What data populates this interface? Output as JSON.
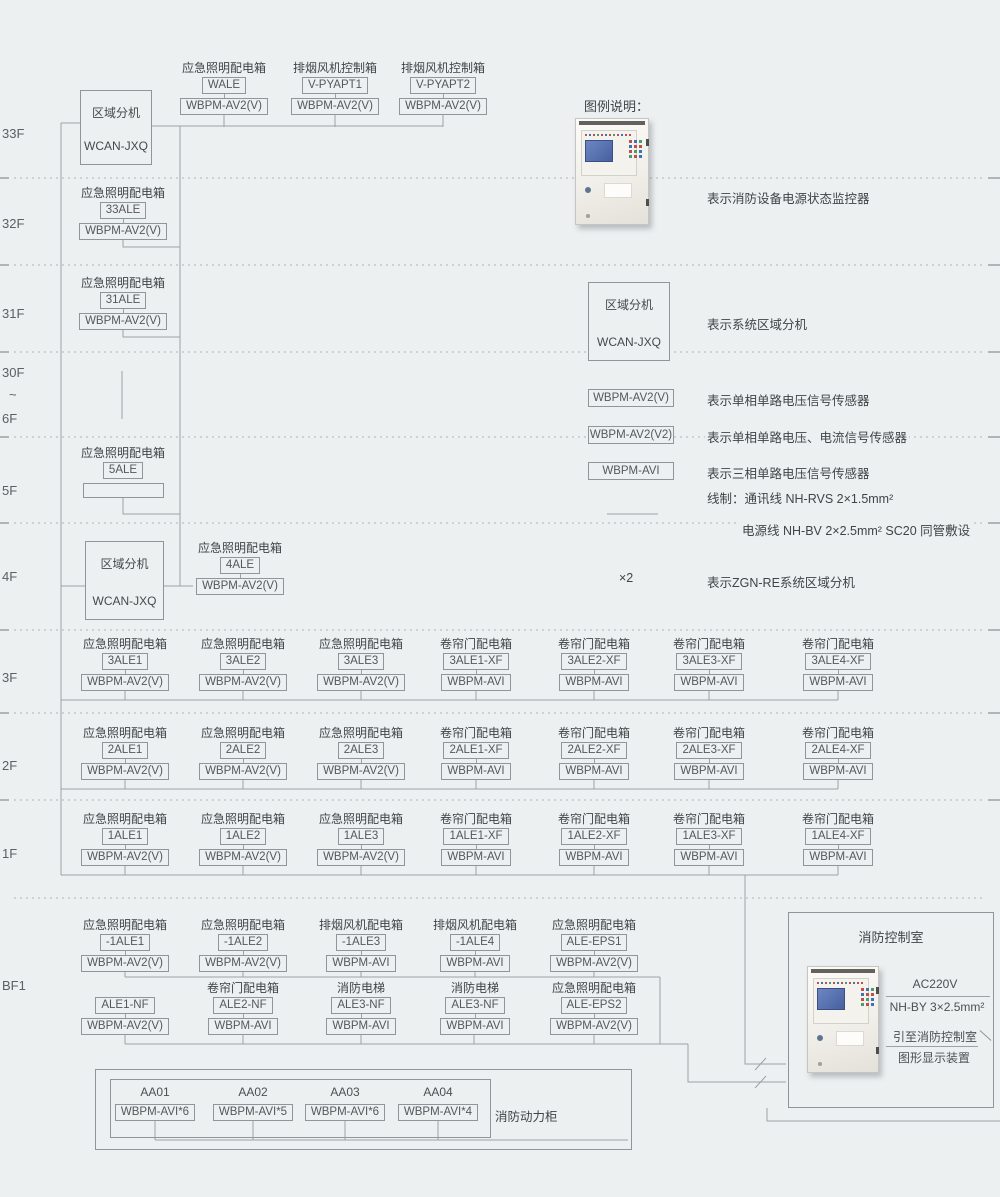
{
  "colors": {
    "background": "#edf0f1",
    "wire_line": "#9aa2a6",
    "box_border": "#8d969a",
    "text": "#4b5053",
    "device_screen_blue": "#46619f"
  },
  "floor_axis": [
    "33F",
    "32F",
    "31F",
    "30F",
    "~",
    "6F",
    "5F",
    "4F",
    "3F",
    "2F",
    "1F",
    "BF1"
  ],
  "zone_unit": {
    "title": "区域分机",
    "model": "WCAN-JXQ"
  },
  "top_units": [
    {
      "title": "应急照明配电箱",
      "code": "WALE",
      "sensor": "WBPM-AV2(V)"
    },
    {
      "title": "排烟风机控制箱",
      "code": "V-PYAPT1",
      "sensor": "WBPM-AV2(V)"
    },
    {
      "title": "排烟风机控制箱",
      "code": "V-PYAPT2",
      "sensor": "WBPM-AV2(V)"
    }
  ],
  "f32": {
    "title": "应急照明配电箱",
    "code": "33ALE",
    "sensor": "WBPM-AV2(V)"
  },
  "f31": {
    "title": "应急照明配电箱",
    "code": "31ALE",
    "sensor": "WBPM-AV2(V)"
  },
  "f5": {
    "title": "应急照明配电箱",
    "code": "5ALE",
    "sensor": ""
  },
  "f4_unit": {
    "title": "应急照明配电箱",
    "code": "4ALE",
    "sensor": "WBPM-AV2(V)"
  },
  "f3_units": [
    {
      "title": "应急照明配电箱",
      "code": "3ALE1",
      "sensor": "WBPM-AV2(V)"
    },
    {
      "title": "应急照明配电箱",
      "code": "3ALE2",
      "sensor": "WBPM-AV2(V)"
    },
    {
      "title": "应急照明配电箱",
      "code": "3ALE3",
      "sensor": "WBPM-AV2(V)"
    },
    {
      "title": "卷帘门配电箱",
      "code": "3ALE1-XF",
      "sensor": "WBPM-AVI"
    },
    {
      "title": "卷帘门配电箱",
      "code": "3ALE2-XF",
      "sensor": "WBPM-AVI"
    },
    {
      "title": "卷帘门配电箱",
      "code": "3ALE3-XF",
      "sensor": "WBPM-AVI"
    },
    {
      "title": "卷帘门配电箱",
      "code": "3ALE4-XF",
      "sensor": "WBPM-AVI"
    }
  ],
  "f2_units": [
    {
      "title": "应急照明配电箱",
      "code": "2ALE1",
      "sensor": "WBPM-AV2(V)"
    },
    {
      "title": "应急照明配电箱",
      "code": "2ALE2",
      "sensor": "WBPM-AV2(V)"
    },
    {
      "title": "应急照明配电箱",
      "code": "2ALE3",
      "sensor": "WBPM-AV2(V)"
    },
    {
      "title": "卷帘门配电箱",
      "code": "2ALE1-XF",
      "sensor": "WBPM-AVI"
    },
    {
      "title": "卷帘门配电箱",
      "code": "2ALE2-XF",
      "sensor": "WBPM-AVI"
    },
    {
      "title": "卷帘门配电箱",
      "code": "2ALE3-XF",
      "sensor": "WBPM-AVI"
    },
    {
      "title": "卷帘门配电箱",
      "code": "2ALE4-XF",
      "sensor": "WBPM-AVI"
    }
  ],
  "f1_units": [
    {
      "title": "应急照明配电箱",
      "code": "1ALE1",
      "sensor": "WBPM-AV2(V)"
    },
    {
      "title": "应急照明配电箱",
      "code": "1ALE2",
      "sensor": "WBPM-AV2(V)"
    },
    {
      "title": "应急照明配电箱",
      "code": "1ALE3",
      "sensor": "WBPM-AV2(V)"
    },
    {
      "title": "卷帘门配电箱",
      "code": "1ALE1-XF",
      "sensor": "WBPM-AVI"
    },
    {
      "title": "卷帘门配电箱",
      "code": "1ALE2-XF",
      "sensor": "WBPM-AVI"
    },
    {
      "title": "卷帘门配电箱",
      "code": "1ALE3-XF",
      "sensor": "WBPM-AVI"
    },
    {
      "title": "卷帘门配电箱",
      "code": "1ALE4-XF",
      "sensor": "WBPM-AVI"
    }
  ],
  "bf1_row1": [
    {
      "title": "应急照明配电箱",
      "code": "-1ALE1",
      "sensor": "WBPM-AV2(V)"
    },
    {
      "title": "应急照明配电箱",
      "code": "-1ALE2",
      "sensor": "WBPM-AV2(V)"
    },
    {
      "title": "排烟风机配电箱",
      "code": "-1ALE3",
      "sensor": "WBPM-AVI"
    },
    {
      "title": "排烟风机配电箱",
      "code": "-1ALE4",
      "sensor": "WBPM-AVI"
    },
    {
      "title": "应急照明配电箱",
      "code": "ALE-EPS1",
      "sensor": "WBPM-AV2(V)"
    }
  ],
  "bf1_row2": [
    {
      "title": "",
      "code": "ALE1-NF",
      "sensor": "WBPM-AV2(V)"
    },
    {
      "title": "卷帘门配电箱",
      "code": "ALE2-NF",
      "sensor": "WBPM-AVI"
    },
    {
      "title": "消防电梯",
      "code": "ALE3-NF",
      "sensor": "WBPM-AVI"
    },
    {
      "title": "消防电梯",
      "code": "ALE3-NF",
      "sensor": "WBPM-AVI"
    },
    {
      "title": "应急照明配电箱",
      "code": "ALE-EPS2",
      "sensor": "WBPM-AV2(V)"
    }
  ],
  "power_cabinet": {
    "label": "消防动力柜",
    "feeders": [
      {
        "code": "AA01",
        "sensor": "WBPM-AVI*6"
      },
      {
        "code": "AA02",
        "sensor": "WBPM-AVI*5"
      },
      {
        "code": "AA03",
        "sensor": "WBPM-AVI*6"
      },
      {
        "code": "AA04",
        "sensor": "WBPM-AVI*4"
      }
    ]
  },
  "control_room": {
    "title": "消防控制室",
    "voltage": "AC220V",
    "cable": "NH-BY 3×2.5mm²",
    "dest_line1": "引至消防控制室",
    "dest_line2": "图形显示装置"
  },
  "legend": {
    "title": "图例说明：",
    "device_caption": "表示消防设备电源状态监控器",
    "zone_caption": "表示系统区域分机",
    "sensors": [
      {
        "symbol": "WBPM-AV2(V)",
        "caption": "表示单相单路电压信号传感器"
      },
      {
        "symbol": "WBPM-AV2(V2)",
        "caption": "表示单相单路电压、电流信号传感器"
      },
      {
        "symbol": "WBPM-AVI",
        "caption": "表示三相单路电压信号传感器"
      }
    ],
    "wire_note_1": "线制：通讯线 NH-RVS 2×1.5mm²",
    "wire_note_2": "电源线 NH-BV 2×2.5mm² SC20 同管敷设",
    "multiplier_symbol": "×2",
    "multiplier_caption": "表示ZGN-RE系统区域分机"
  }
}
